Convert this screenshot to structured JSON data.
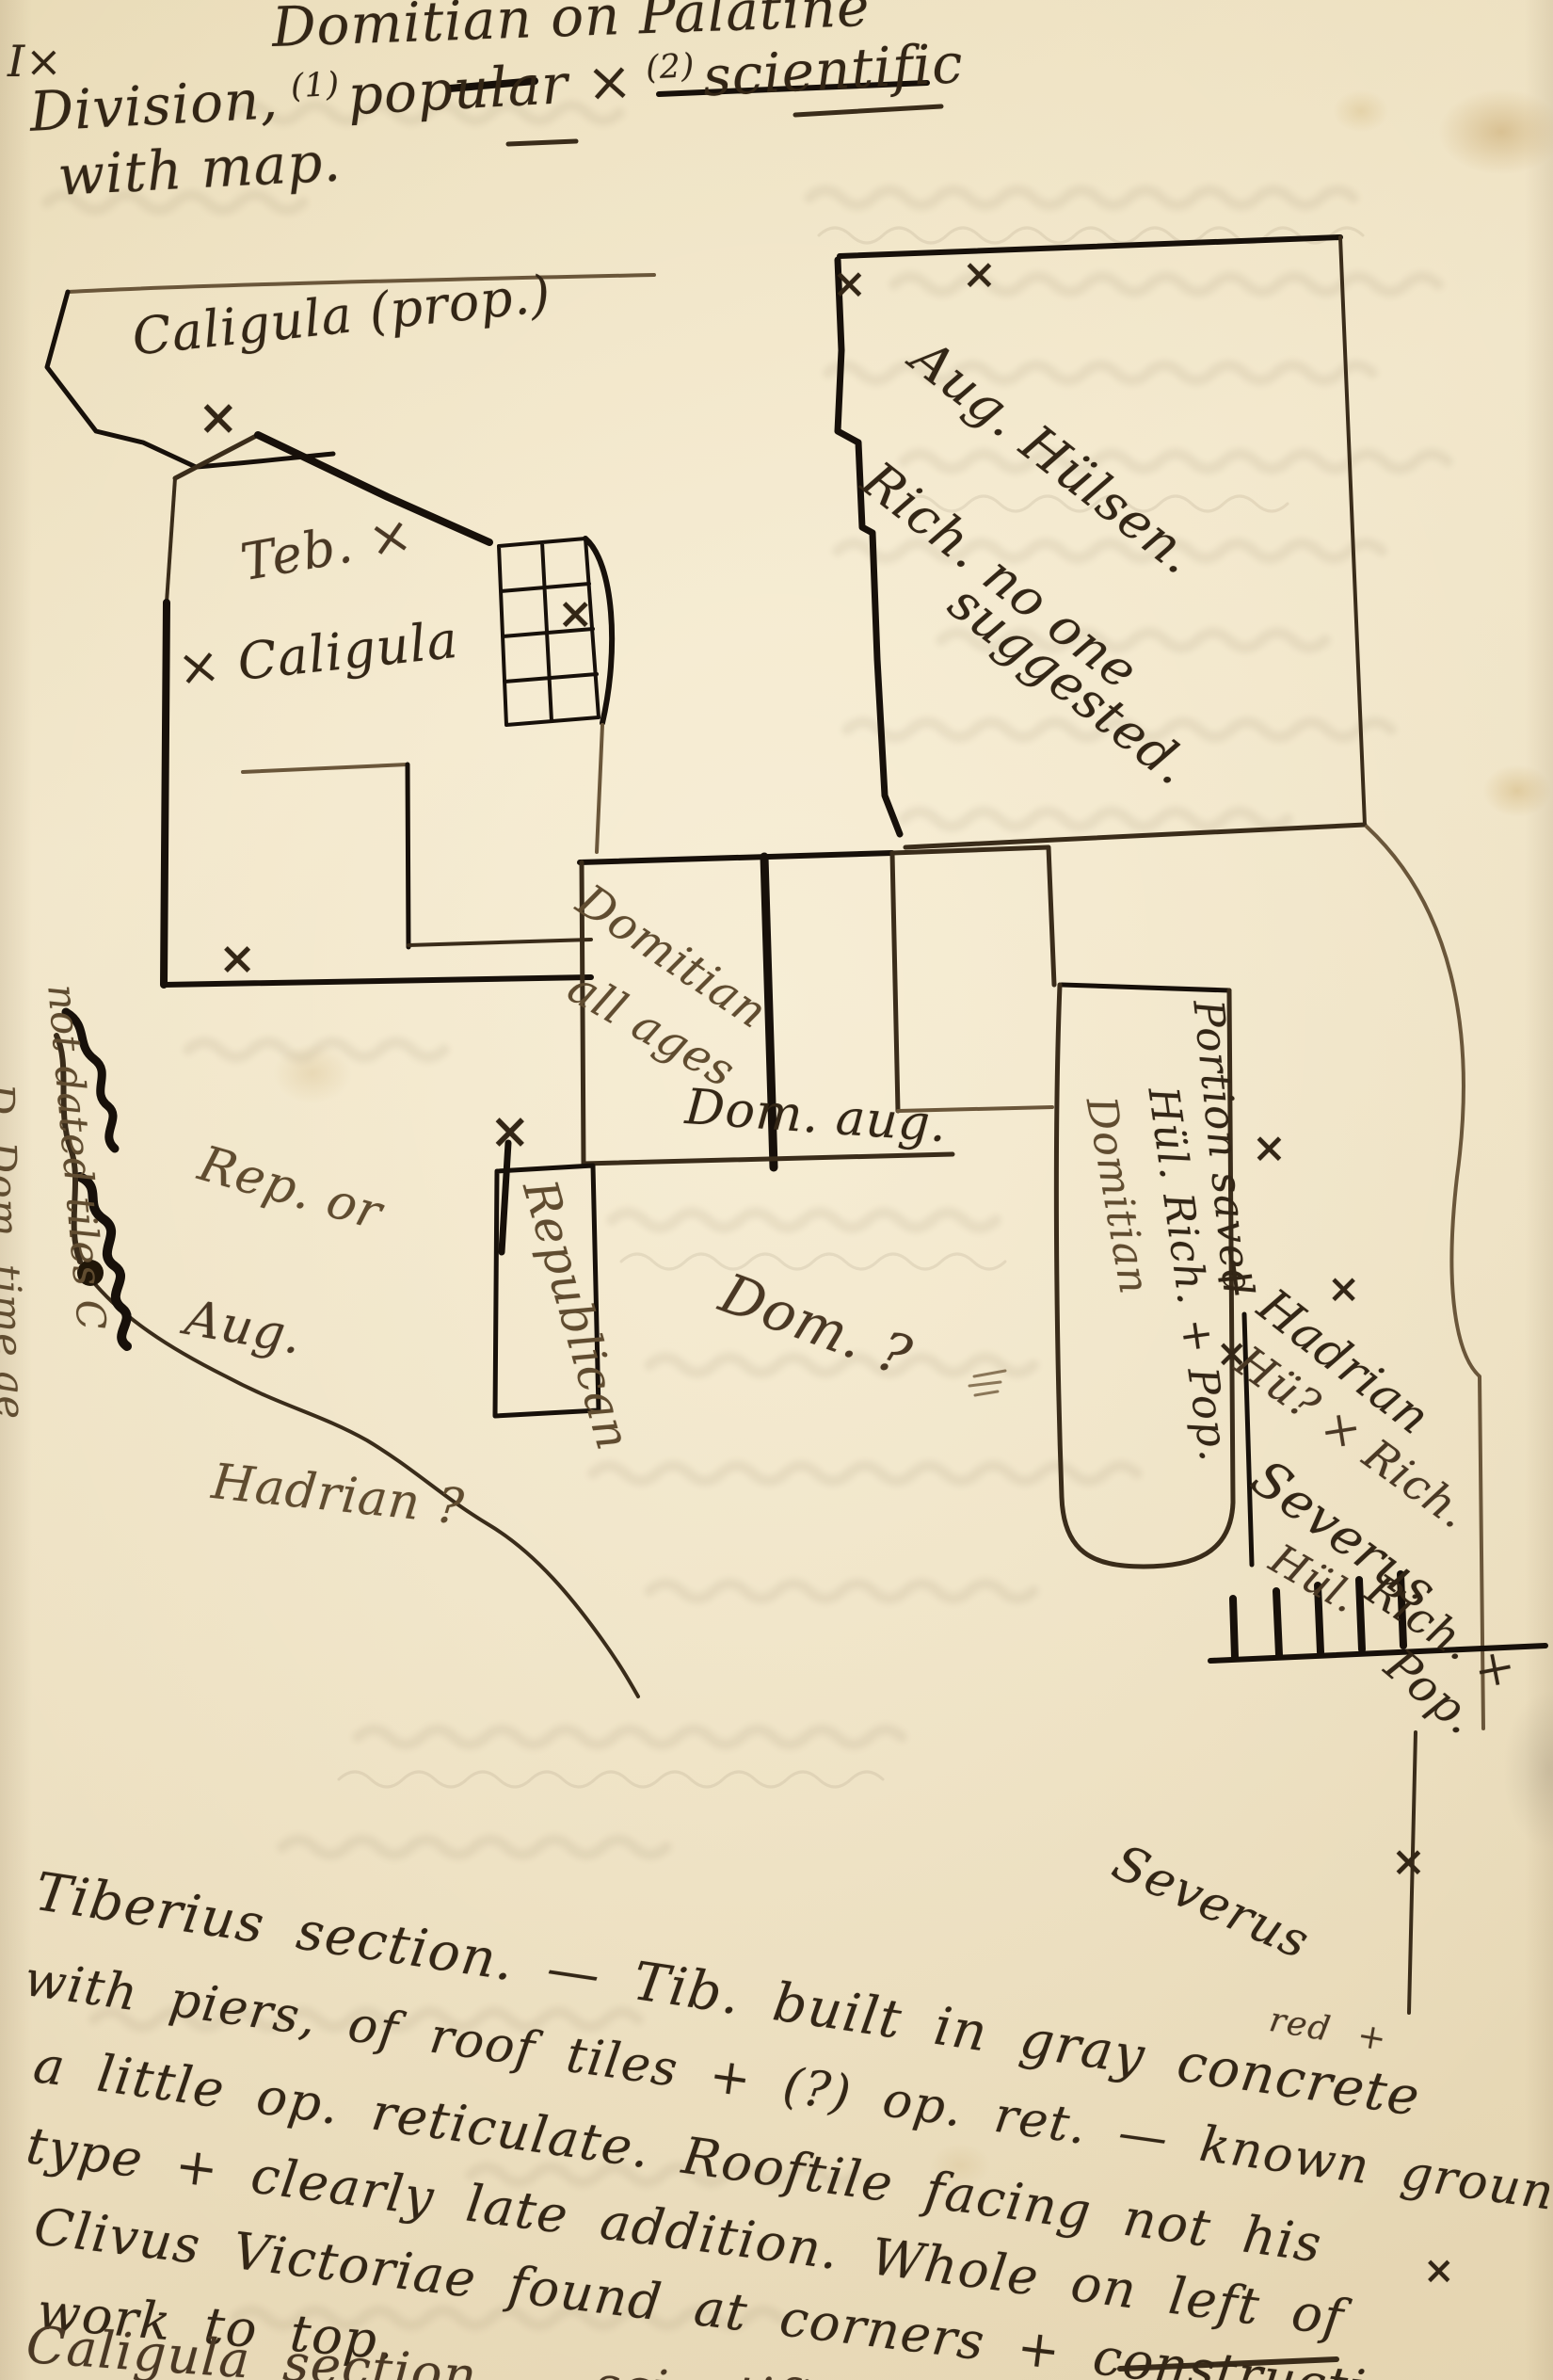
{
  "page": {
    "corner_mark": "I×",
    "title": {
      "line1": "Domitian on Palatine",
      "line2_pre": "Division,",
      "line2_sup1": "(1)",
      "line2_mid": "popular ×",
      "line2_sup2": "(2)",
      "line2_post": "scientific",
      "line3": "with map."
    }
  },
  "map": {
    "mark_glyph": "×",
    "labels": {
      "caligula_prop": "Caligula (prop.)",
      "teb": "Teb. ×",
      "caligula": "× Caligula",
      "aug_hulsen_1": "Aug. Hülsen.",
      "aug_hulsen_2": "Rich. no one",
      "aug_hulsen_3": "suggested.",
      "domitian_1": "Domitian",
      "domitian_2": "all ages",
      "dom_aug": "Dom. aug.",
      "rep_or": "Rep. or",
      "aug": "Aug.",
      "republican": "Republican",
      "dom_q": "Dom. ?",
      "hadrian_q": "Hadrian ?",
      "strip_domitian": "Domitian",
      "strip_hul": "Hül. Rich. + Pop.",
      "strip_portion": "Portion saved",
      "hadrian2_1": "× Hadrian",
      "hadrian2_2": "Hü? × Rich.",
      "severus_1": "Severus",
      "severus_2": "Hül.",
      "severus_3": "Rich. ×",
      "severus_4": "Pop.",
      "severus_note": "Severus"
    },
    "margin_notes": {
      "line1": "D. Dom. time ae",
      "line2": "not dated tiles C"
    }
  },
  "notes": {
    "insert_red": "red +",
    "lines": [
      "Tiberius section. — Tib. built in gray concrete",
      "with piers, of roof tiles + (?) op. ret. — known ground found",
      "a little op. reticulate. Rooftile facing not his",
      "type + clearly late addition. Whole on left of",
      "Clivus Victoriae found at corners + construction",
      "work to top.",
      "Caligula section — scientifically Hadrian. on"
    ]
  }
}
